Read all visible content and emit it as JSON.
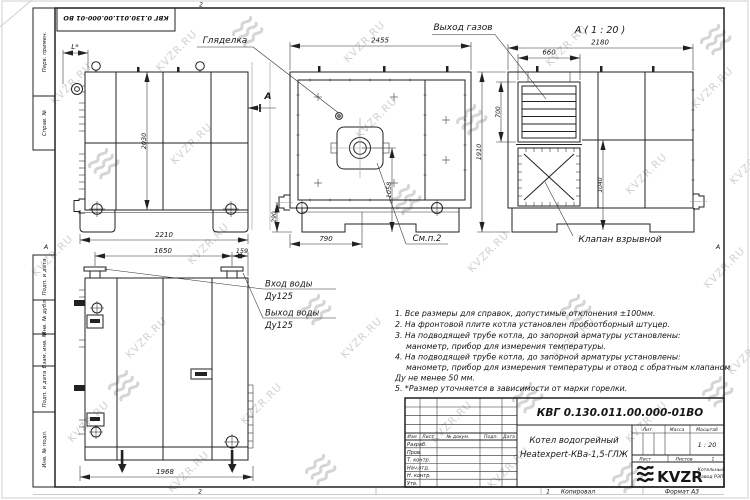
{
  "watermark": {
    "text": "KVZR.RU"
  },
  "frame": {
    "designation_flipped": "КВГ 0.130.011.00.000-01 ВО",
    "zone_letter_left": "А",
    "zone_letter_right": "А",
    "zone_top": "2",
    "zone_bottom": "2",
    "sheet_no": "1",
    "copied": "Копировал",
    "format": "Формат А3",
    "side_labels": [
      "Перв. примен.",
      "Справ. №",
      "Подп. и дата",
      "Инв. № дубл.",
      "Взам. инв. №",
      "Подп. и дата",
      "Инв. № подл."
    ]
  },
  "views": {
    "side": {
      "dim_l": "L*",
      "dim_2030": "2030",
      "dim_2210": "2210",
      "section_letter": "А"
    },
    "front": {
      "label_sight": "Гляделка",
      "dim_2455": "2455",
      "dim_1058": "1058",
      "dim_790": "790",
      "dim_290": "290",
      "label_see": "См.п.2"
    },
    "section": {
      "title": "А ( 1 : 20 )",
      "label_gas": "Выход газов",
      "dim_2180": "2180",
      "dim_660": "660",
      "dim_700": "700",
      "dim_1910": "1910",
      "dim_1040": "1040",
      "label_valve": "Клапан взрывной"
    },
    "rear": {
      "dim_1650": "1650",
      "dim_159": "159",
      "dim_1968": "1968",
      "inlet_line1": "Вход воды",
      "inlet_line2": "Ду125",
      "outlet_line1": "Выход воды",
      "outlet_line2": "Ду125"
    }
  },
  "notes": [
    "1. Все размеры для справок, допустимые отклонения ±100мм.",
    "2. На фронтовой плите котла установлен пробоотборный штуцер.",
    "3. На подводящей трубе котла, до запорной арматуры установлены:",
    "манометр, прибор для измерения температуры.",
    "4. На подводящей трубе котла, до запорной арматуры установлены:",
    "манометр, прибор для измерения температуры и отвод с обратным клапаном",
    "Ду не менее 50 мм.",
    "5. *Размер уточняется в зависимости от марки горелки."
  ],
  "title_block": {
    "designation": "КВГ 0.130.011.00.000-01ВО",
    "product_line1": "Котел водогрейный",
    "product_line2": "Heatexpert-КВа-1,5-ГЛЖ",
    "col_izm": "Изм",
    "col_list": "Лист",
    "col_doc": "№ докум.",
    "col_sign": "Подп.",
    "col_date": "Дата",
    "row_labels": [
      "Разраб.",
      "Пров.",
      "Т. контр.",
      "Нач.отд.",
      "Н. контр.",
      "Утв."
    ],
    "lit": "Лит.",
    "mass": "Масса",
    "scale": "Масштаб",
    "scale_value": "1 : 20",
    "sheet": "Лист",
    "sheets": "Листов",
    "sheets_value": "1",
    "logo": "KVZR",
    "company_line1": "Котельный",
    "company_line2": "завод РЭП"
  }
}
